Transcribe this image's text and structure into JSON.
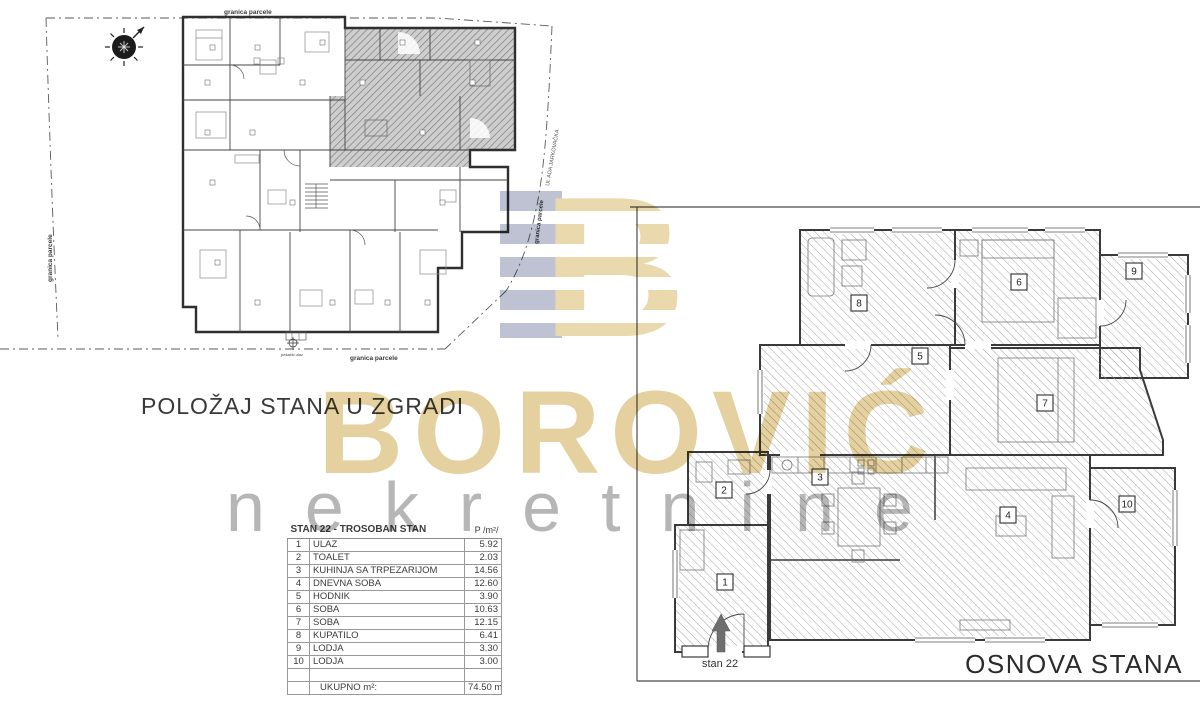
{
  "page": {
    "background": "#ffffff"
  },
  "watermark": {
    "brand": "BOROVIĆ",
    "tagline": "nekretnine",
    "brand_color": "#d3b564",
    "tagline_color": "#7a7a7a",
    "logo": {
      "gold": "#e2cc90",
      "blue": "#a9aec4"
    }
  },
  "left_plan": {
    "title": "POLOŽAJ STANA U ZGRADI",
    "labels": {
      "boundary_top": "granica parcele",
      "boundary_left": "granica parcele",
      "boundary_bottom": "granica parcele",
      "boundary_right": "granica parcele",
      "street": "Ul. ADA JARKOVAČKA",
      "entrance": "pešački ulaz"
    }
  },
  "right_plan": {
    "title": "OSNOVA STANA",
    "apartment_label": "stan 22",
    "rooms": [
      "1",
      "2",
      "3",
      "4",
      "5",
      "6",
      "7",
      "8",
      "9",
      "10"
    ]
  },
  "table": {
    "title": "STAN 22 - TROSOBAN STAN",
    "area_header": "P /m²/",
    "rows": [
      {
        "num": "1",
        "name": "ULAZ",
        "area": "5.92"
      },
      {
        "num": "2",
        "name": "TOALET",
        "area": "2.03"
      },
      {
        "num": "3",
        "name": "KUHINJA SA TRPEZARIJOM",
        "area": "14.56"
      },
      {
        "num": "4",
        "name": "DNEVNA SOBA",
        "area": "12.60"
      },
      {
        "num": "5",
        "name": "HODNIK",
        "area": "3.90"
      },
      {
        "num": "6",
        "name": "SOBA",
        "area": "10.63"
      },
      {
        "num": "7",
        "name": "SOBA",
        "area": "12.15"
      },
      {
        "num": "8",
        "name": "KUPATILO",
        "area": "6.41"
      },
      {
        "num": "9",
        "name": "LODJA",
        "area": "3.30"
      },
      {
        "num": "10",
        "name": "LODJA",
        "area": "3.00"
      }
    ],
    "total_label": "UKUPNO m²:",
    "total_value": "74.50 m²"
  }
}
